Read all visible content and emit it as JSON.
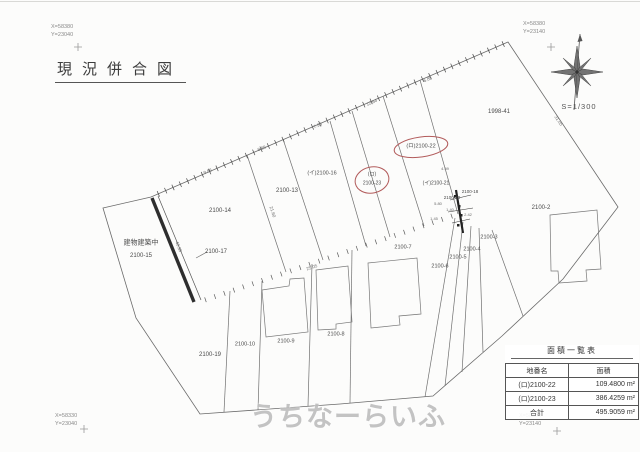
{
  "title": "現況併合図",
  "scale_label": "S=1/300",
  "corner_coords": {
    "top_left": {
      "x_label": "X=58380",
      "y_label": "Y=23040"
    },
    "top_right": {
      "x_label": "X=58380",
      "y_label": "Y=23140"
    },
    "bottom_left": {
      "x_label": "X=58330",
      "y_label": "Y=23040"
    },
    "bottom_right": {
      "x_label": "X=58330",
      "y_label": "Y=23140"
    }
  },
  "watermark": "うちなーらいふ",
  "accent_colors": {
    "highlight_oval": "#b25b5b",
    "line": "#6a6a6a"
  },
  "area_table": {
    "title": "面積一覧表",
    "headers": [
      "地番名",
      "面積"
    ],
    "rows": [
      {
        "name": "(ロ)2100-22",
        "area": "109.4800 m²"
      },
      {
        "name": "(ロ)2100-23",
        "area": "386.4259 m²"
      },
      {
        "name": "合計",
        "area": "495.9059 m²"
      }
    ]
  },
  "map": {
    "labels": [
      {
        "text": "建物建築中",
        "x": 141,
        "y": 243,
        "size": 7,
        "rot": 0,
        "kind": "note"
      },
      {
        "text": "2100-15",
        "x": 141,
        "y": 256,
        "size": 6,
        "rot": 0,
        "kind": "parcel"
      },
      {
        "text": "2100-17",
        "x": 216,
        "y": 252,
        "size": 6,
        "rot": 0,
        "kind": "parcel"
      },
      {
        "text": "2100-14",
        "x": 220,
        "y": 211,
        "size": 6,
        "rot": 0,
        "kind": "parcel"
      },
      {
        "text": "2100-13",
        "x": 287,
        "y": 191,
        "size": 6,
        "rot": 0,
        "kind": "parcel"
      },
      {
        "text": "(イ)2100-16",
        "x": 322,
        "y": 174,
        "size": 5.5,
        "rot": 0,
        "kind": "parcel"
      },
      {
        "text": "(ロ)",
        "x": 372,
        "y": 175,
        "size": 5,
        "rot": 0,
        "kind": "parcel"
      },
      {
        "text": "2100-23",
        "x": 372,
        "y": 184,
        "size": 5,
        "rot": 0,
        "kind": "parcel"
      },
      {
        "text": "(ロ)2100-22",
        "x": 421,
        "y": 147,
        "size": 5.5,
        "rot": 0,
        "kind": "parcel"
      },
      {
        "text": "(イ)2100-21",
        "x": 436,
        "y": 184,
        "size": 5,
        "rot": 0,
        "kind": "parcel"
      },
      {
        "text": "2100-20",
        "x": 452,
        "y": 198,
        "size": 4.5,
        "rot": 0,
        "kind": "parcel"
      },
      {
        "text": "2100-18",
        "x": 470,
        "y": 192,
        "size": 4.5,
        "rot": 0,
        "kind": "parcel"
      },
      {
        "text": "1998-41",
        "x": 499,
        "y": 112,
        "size": 6,
        "rot": 0,
        "kind": "parcel"
      },
      {
        "text": "2100-2",
        "x": 541,
        "y": 208,
        "size": 6,
        "rot": 0,
        "kind": "parcel"
      },
      {
        "text": "2100-3",
        "x": 489,
        "y": 238,
        "size": 5.5,
        "rot": 0,
        "kind": "parcel"
      },
      {
        "text": "2100-4",
        "x": 472,
        "y": 250,
        "size": 5.5,
        "rot": 0,
        "kind": "parcel"
      },
      {
        "text": "2100-5",
        "x": 458,
        "y": 258,
        "size": 5.5,
        "rot": 0,
        "kind": "parcel"
      },
      {
        "text": "2100-6",
        "x": 440,
        "y": 267,
        "size": 5.5,
        "rot": 0,
        "kind": "parcel"
      },
      {
        "text": "2100-7",
        "x": 403,
        "y": 248,
        "size": 5.5,
        "rot": 0,
        "kind": "parcel"
      },
      {
        "text": "2100-8",
        "x": 336,
        "y": 335,
        "size": 5.5,
        "rot": 0,
        "kind": "parcel"
      },
      {
        "text": "2100-9",
        "x": 286,
        "y": 342,
        "size": 5.5,
        "rot": 0,
        "kind": "parcel"
      },
      {
        "text": "2100-10",
        "x": 245,
        "y": 345,
        "size": 5.5,
        "rot": 0,
        "kind": "parcel"
      },
      {
        "text": "2100-19",
        "x": 210,
        "y": 355,
        "size": 6,
        "rot": 0,
        "kind": "parcel"
      },
      {
        "text": "9.86",
        "x": 208,
        "y": 172,
        "size": 4.5,
        "rot": -23,
        "kind": "measure"
      },
      {
        "text": "8.65",
        "x": 262,
        "y": 149,
        "size": 4.5,
        "rot": -23,
        "kind": "measure"
      },
      {
        "text": "7.95",
        "x": 318,
        "y": 126,
        "size": 4.5,
        "rot": -23,
        "kind": "measure"
      },
      {
        "text": "12.64",
        "x": 372,
        "y": 103,
        "size": 4.5,
        "rot": -23,
        "kind": "measure"
      },
      {
        "text": "6.85",
        "x": 428,
        "y": 80,
        "size": 4.5,
        "rot": -23,
        "kind": "measure"
      },
      {
        "text": "40.39",
        "x": 178,
        "y": 247,
        "size": 4.5,
        "rot": 68,
        "kind": "measure"
      },
      {
        "text": "21.60",
        "x": 272,
        "y": 212,
        "size": 4.5,
        "rot": 72,
        "kind": "measure"
      },
      {
        "text": "31.05",
        "x": 558,
        "y": 121,
        "size": 4.5,
        "rot": 56,
        "kind": "measure"
      },
      {
        "text": "25.05",
        "x": 312,
        "y": 268,
        "size": 4.5,
        "rot": -19,
        "kind": "measure"
      },
      {
        "text": "4.59",
        "x": 445,
        "y": 169,
        "size": 4,
        "rot": 0,
        "kind": "measure"
      },
      {
        "text": "5.80",
        "x": 438,
        "y": 204,
        "size": 4,
        "rot": 0,
        "kind": "measure"
      },
      {
        "text": "1.40",
        "x": 450,
        "y": 210,
        "size": 4,
        "rot": 0,
        "kind": "measure"
      },
      {
        "text": "1.45",
        "x": 434,
        "y": 219,
        "size": 4,
        "rot": 0,
        "kind": "measure"
      },
      {
        "text": "2.42",
        "x": 468,
        "y": 215,
        "size": 4,
        "rot": 0,
        "kind": "measure"
      }
    ]
  }
}
